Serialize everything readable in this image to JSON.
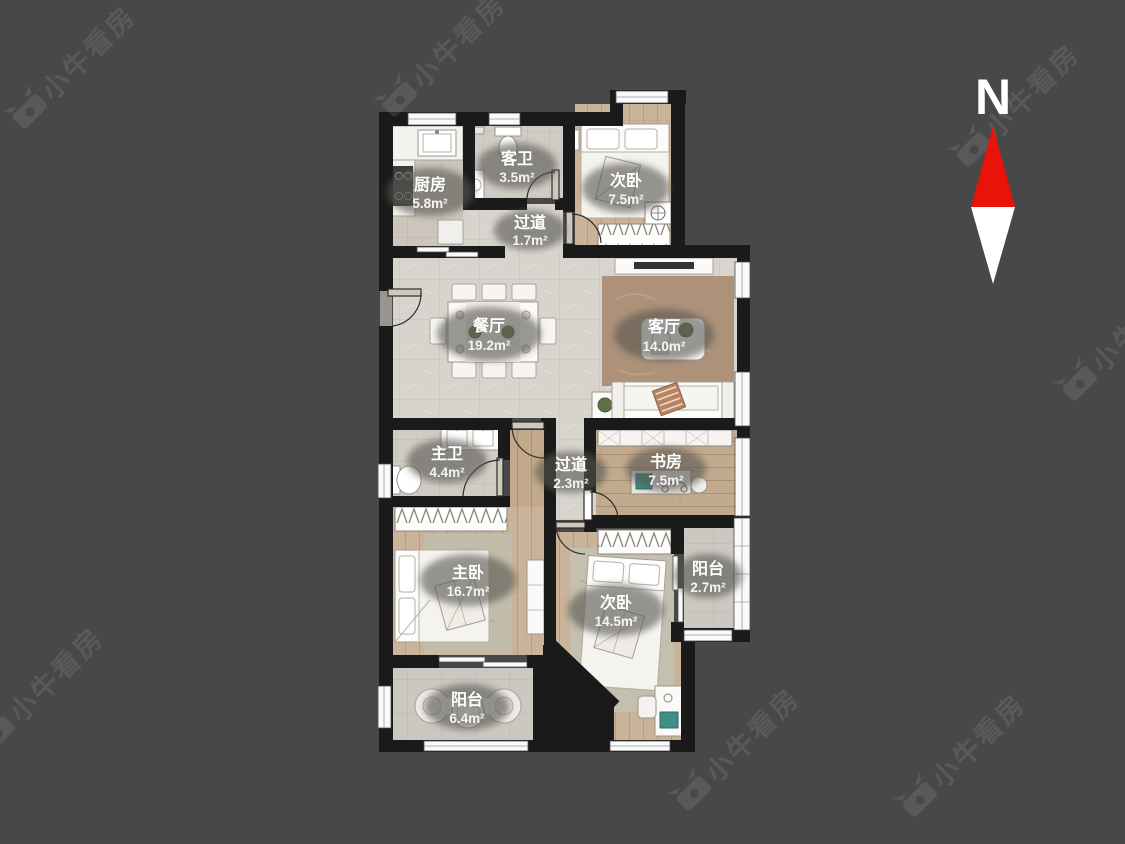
{
  "background": {
    "color": "#484848",
    "wall_color": "#1a1a1a"
  },
  "compass": {
    "label": "N",
    "arrow_red": "#e81309",
    "arrow_white": "#ffffff"
  },
  "watermark": {
    "text": "小牛看房"
  },
  "rooms": [
    {
      "id": "kitchen",
      "name": "厨房",
      "area": "5.8m²"
    },
    {
      "id": "guest-bath",
      "name": "客卫",
      "area": "3.5m²"
    },
    {
      "id": "bedroom-north",
      "name": "次卧",
      "area": "7.5m²"
    },
    {
      "id": "hallway-north",
      "name": "过道",
      "area": "1.7m²"
    },
    {
      "id": "dining-room",
      "name": "餐厅",
      "area": "19.2m²"
    },
    {
      "id": "living-room",
      "name": "客厅",
      "area": "14.0m²"
    },
    {
      "id": "master-bath",
      "name": "主卫",
      "area": "4.4m²"
    },
    {
      "id": "hallway-south",
      "name": "过道",
      "area": "2.3m²"
    },
    {
      "id": "study",
      "name": "书房",
      "area": "7.5m²"
    },
    {
      "id": "master-bedroom",
      "name": "主卧",
      "area": "16.7m²"
    },
    {
      "id": "bedroom-south",
      "name": "次卧",
      "area": "14.5m²"
    },
    {
      "id": "balcony-east",
      "name": "阳台",
      "area": "2.7m²"
    },
    {
      "id": "balcony-south",
      "name": "阳台",
      "area": "6.4m²"
    }
  ]
}
